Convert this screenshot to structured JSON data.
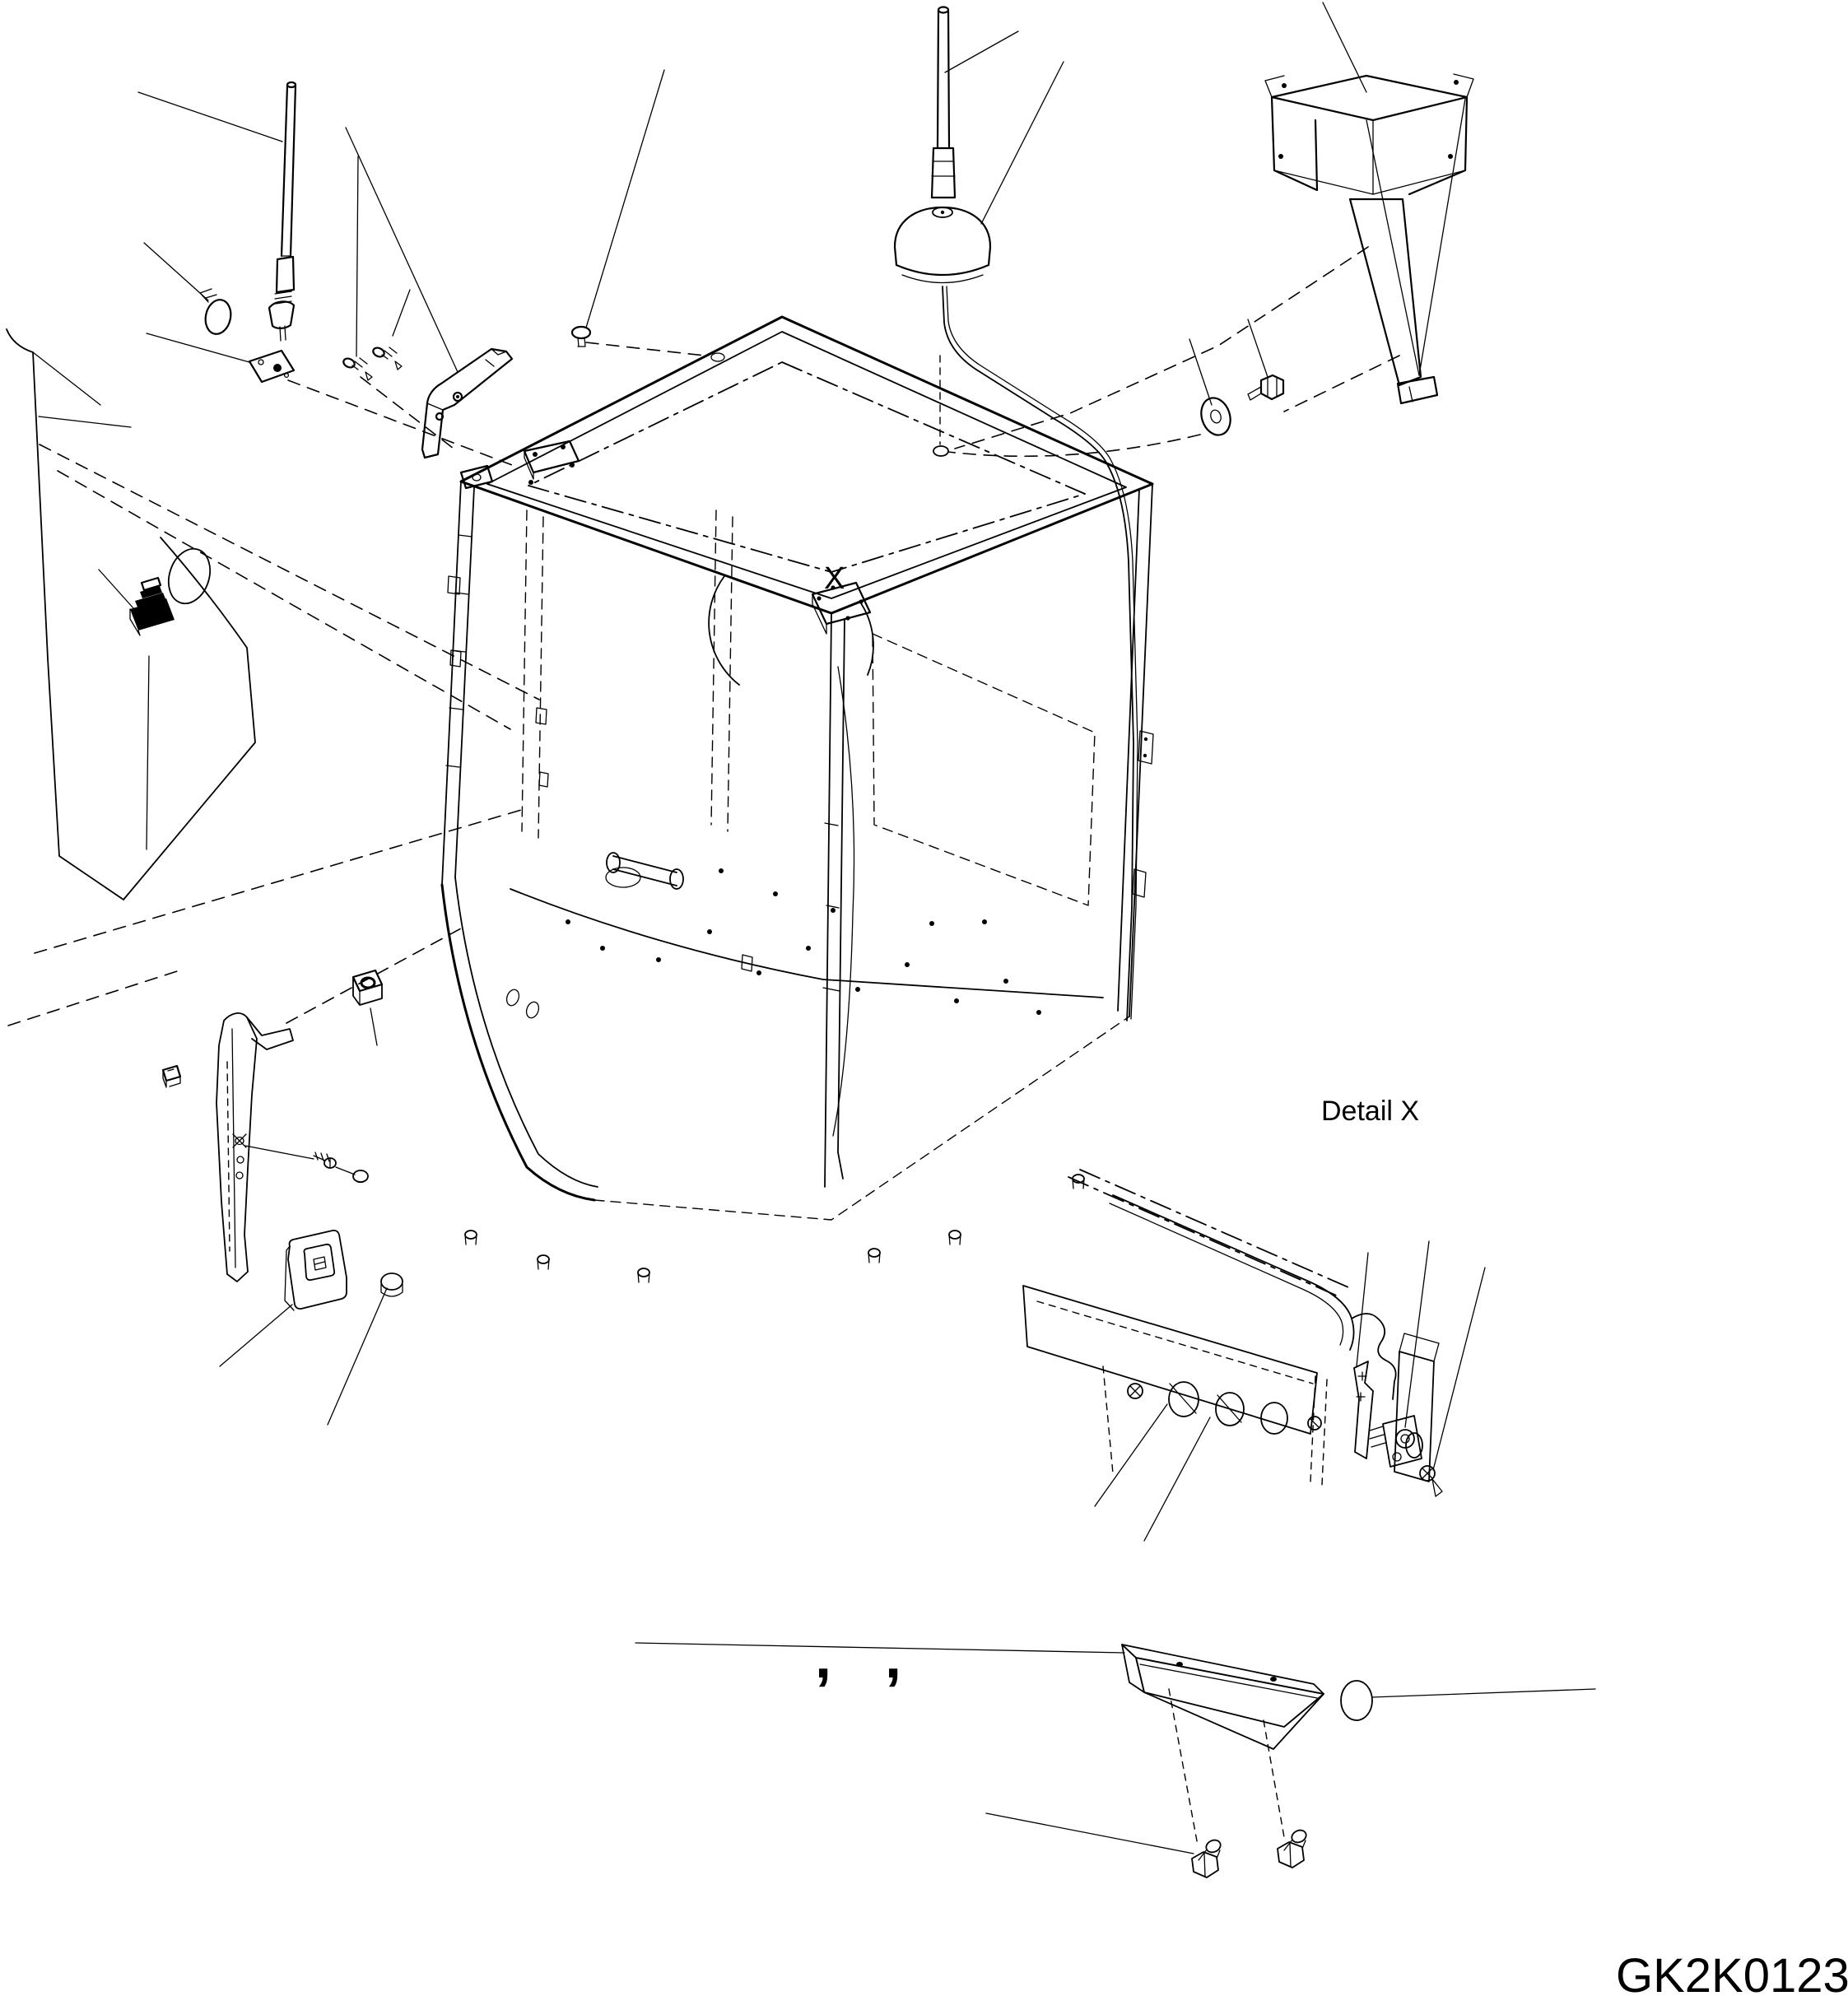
{
  "figure": {
    "detail_marker": "X",
    "detail_caption": "Detail X",
    "code": "GK2K0123",
    "separator_left": ",",
    "separator_right": ","
  },
  "style": {
    "line_color": "#000000",
    "background_color": "#ffffff"
  }
}
